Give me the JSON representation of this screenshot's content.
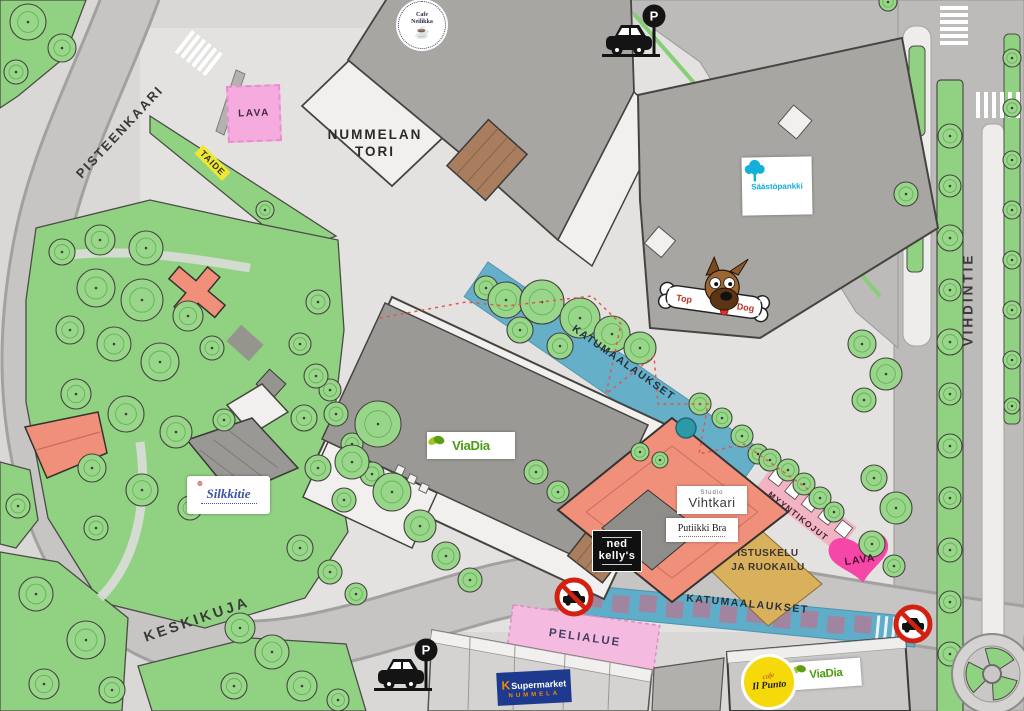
{
  "palette": {
    "background": "#d9d8d6",
    "plaza": "#e3e2e0",
    "road": "#c6c5c3",
    "green": "#90d282",
    "building_gray": "#a8a6a2",
    "building_white": "#f1f0ee",
    "building_salmon": "#f0907b",
    "deck_brown": "#a87e5f",
    "event_blue": "#5fadc8",
    "event_pink": "#f6abde",
    "heart_pink": "#f646a8",
    "stalls_pink": "#f2b3c3",
    "seating_tan": "#d9b05c",
    "art_yellow": "#f0e82f",
    "dashed_red": "#e2574b",
    "no_entry_red": "#d32011"
  },
  "streets": {
    "pisteenkaari": "PISTEENKAARI",
    "vihdintie": "VIHDINTIE",
    "keskikuja": "KESKIKUJA"
  },
  "square": {
    "line1": "NUMMELAN",
    "line2": "TORI"
  },
  "event_areas": {
    "stage_top": "LAVA",
    "art": "TAIDE",
    "street_paintings_upper": "KATUMAALAUKSET",
    "street_paintings_lower": "KATUMAALAUKSET",
    "market_stalls": "MYYNTIKOJUT",
    "seating_line1": "ISTUSKELU",
    "seating_line2": "JA RUOKAILU",
    "stage_heart": "LAVA",
    "play_area": "PELIALUE"
  },
  "logos": {
    "cafe_neilikka_line1": "Cafe",
    "cafe_neilikka_line2": "Neilikka",
    "saastopankki": "Säästöpankki",
    "top_dog_left": "Top",
    "top_dog_right": "Dog",
    "viadia": "ViaDia",
    "silkkitie": "Silkkitie",
    "studio": "Studio",
    "vihtkari": "Vihtkari",
    "putiikki_bra": "Putiikki Bra",
    "ned": "ned",
    "kellys": "kelly's",
    "k": "K",
    "supermarket": "Supermarket",
    "nummela": "NUMMELA",
    "cafe": "cafe",
    "il_punto": "Il Punto",
    "parking": "P"
  }
}
